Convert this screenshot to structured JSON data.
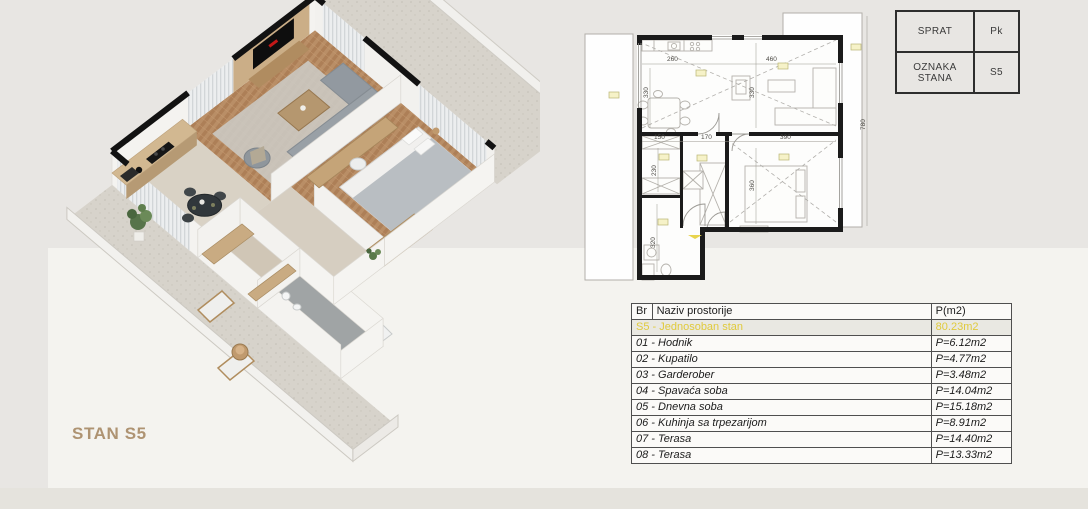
{
  "render3d": {
    "caption": "STAN S5"
  },
  "plan2d": {
    "dims": {
      "kitchen_w": "260",
      "living_w": "460",
      "kitchen_h": "330",
      "living_h": "330",
      "gard_w": "150",
      "hall_w": "170",
      "bedroom_w": "390",
      "gard_h": "230",
      "bedroom_h": "360",
      "bath_h": "320",
      "terrace_h": "780"
    }
  },
  "unit_info": {
    "rows": [
      {
        "label": "SPRAT",
        "value": "Pk"
      },
      {
        "label": "OZNAKA STANA",
        "value": "S5"
      }
    ]
  },
  "room_table": {
    "headers": {
      "br": "Br",
      "name": "Naziv prostorije",
      "area": "P(m2)"
    },
    "summary": {
      "name": "S5 - Jednosoban stan",
      "area": "80.23m2"
    },
    "rows": [
      {
        "name": "01 - Hodnik",
        "area": "P=6.12m2"
      },
      {
        "name": "02 - Kupatilo",
        "area": "P=4.77m2"
      },
      {
        "name": "03 - Garderober",
        "area": "P=3.48m2"
      },
      {
        "name": "04 - Spavaća soba",
        "area": "P=14.04m2"
      },
      {
        "name": "05 - Dnevna soba",
        "area": "P=15.18m2"
      },
      {
        "name": "06 - Kuhinja sa trpezarijom",
        "area": "P=8.91m2"
      },
      {
        "name": "07 - Terasa",
        "area": "P=14.40m2"
      },
      {
        "name": "08 - Terasa",
        "area": "P=13.33m2"
      }
    ]
  }
}
